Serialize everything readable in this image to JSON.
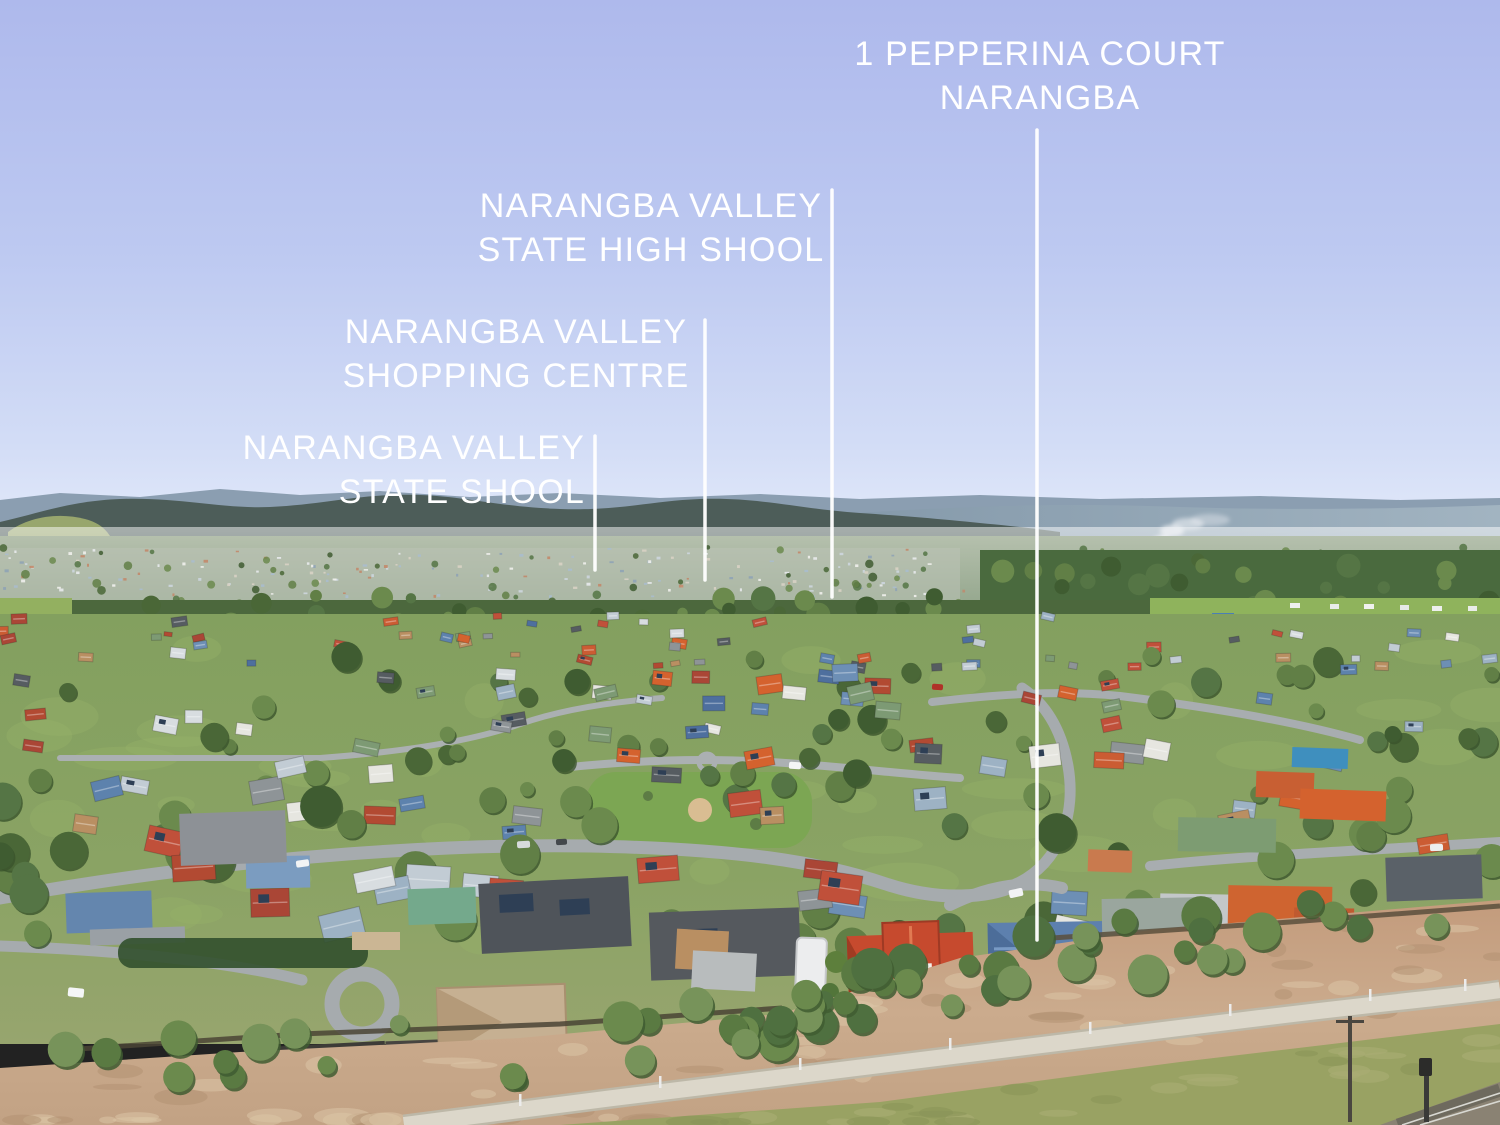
{
  "annotations": {
    "property": {
      "line1": "1 PEPPERINA COURT",
      "line2": "NARANGBA"
    },
    "high_school": {
      "line1": "NARANGBA VALLEY",
      "line2": "STATE HIGH SHOOL"
    },
    "shopping": {
      "line1": "NARANGBA VALLEY",
      "line2": "SHOPPING CENTRE"
    },
    "state_school": {
      "line1": "NARANGBA VALLEY",
      "line2": "STATE SHOOL"
    }
  },
  "palette": {
    "label_text": "#ffffff",
    "leader_line": "#ffffff",
    "sky_top": "#aeb9ec",
    "sky_horizon": "#e7edfb",
    "mountains": "#4d5d59",
    "subject_red_roof": "#c64a2e",
    "pointed_blue_roof": "#5d80ae",
    "pool_water": "#41a8d8",
    "foreground_dirt": "#c8a88a"
  }
}
